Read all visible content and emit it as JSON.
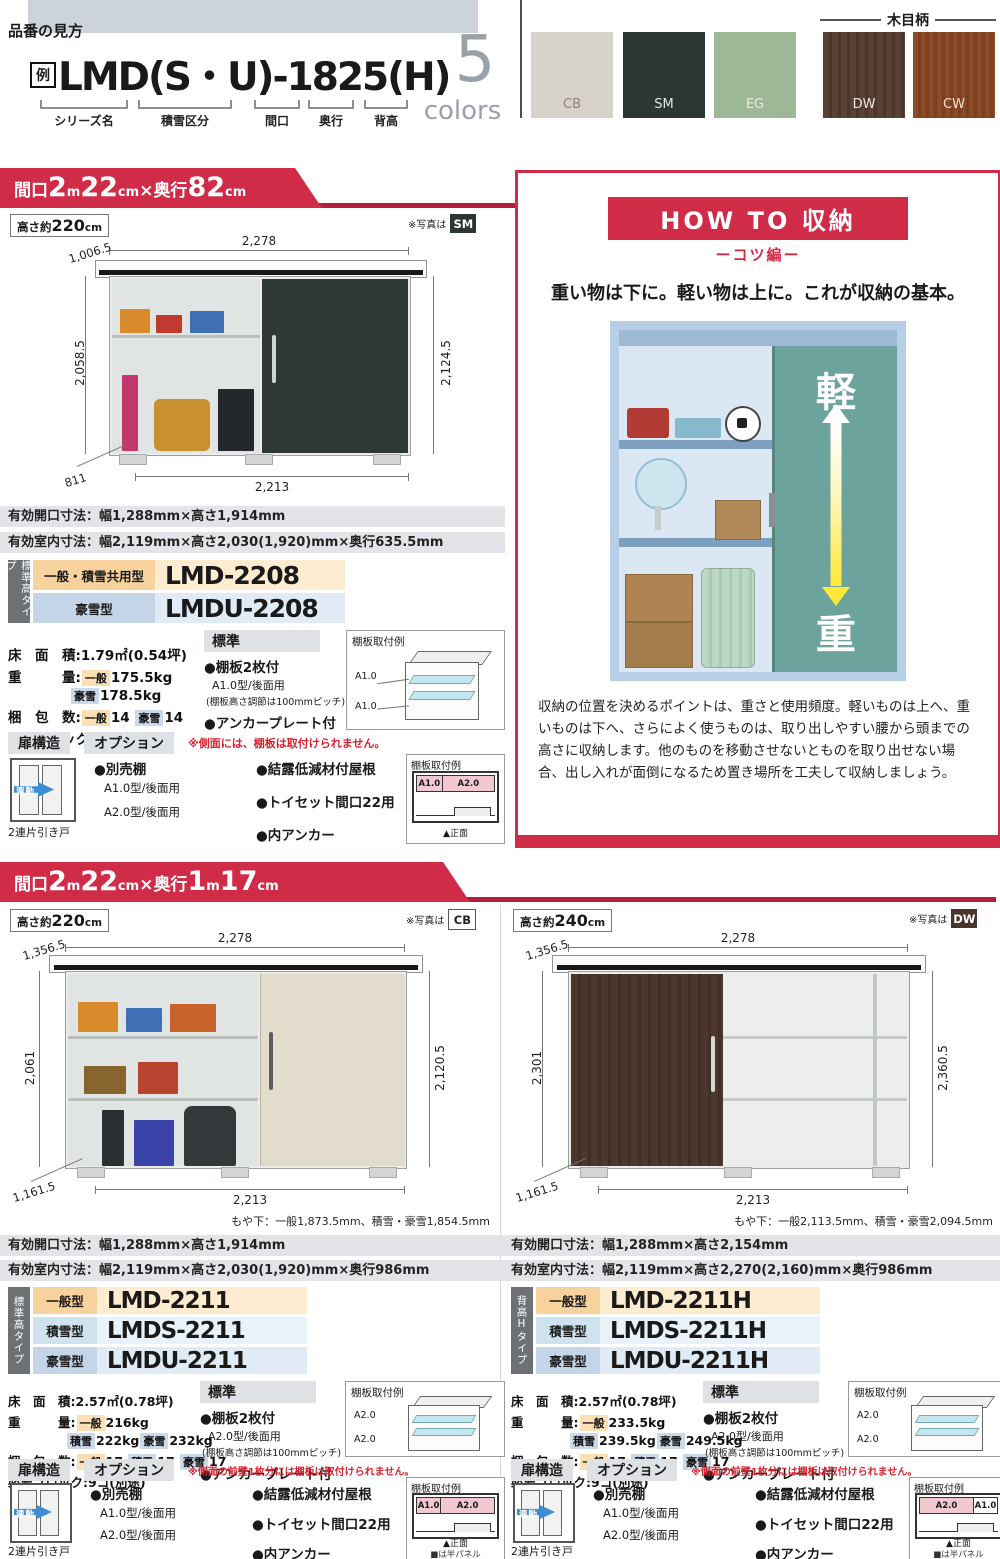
{
  "header": {
    "eyebrow": "品番の見方",
    "example_badge": "例",
    "model_code": "LMD(S・U)-1825(H)",
    "legend": [
      "シリーズ名",
      "積雪区分",
      "間口",
      "奥行",
      "背高"
    ],
    "colors_number": "5",
    "colors_word": "colors",
    "wood_grain_label": "木目柄",
    "swatches": [
      {
        "code": "CB",
        "hex": "#d6d1c9"
      },
      {
        "code": "SM",
        "hex": "#2c3734"
      },
      {
        "code": "EG",
        "hex": "#9eb897"
      },
      {
        "code": "DW",
        "hex": "#5a4136"
      },
      {
        "code": "CW",
        "hex": "#8d4a26"
      }
    ],
    "accent_red": "#d02c47"
  },
  "section1": {
    "ribbon": [
      "間口",
      "2",
      "m",
      "22",
      "cm",
      "×",
      "奥行",
      "82",
      "cm"
    ],
    "height_label": [
      "高さ約",
      "220",
      "cm"
    ],
    "photo_note": "※写真は",
    "photo_chip": "SM",
    "dims": {
      "depth_top": "1,006.5",
      "width_top": "2,278",
      "left": "2,058.5",
      "right": "2,124.5",
      "depth_bottom": "811",
      "width_bottom": "2,213"
    },
    "spec_bars": [
      "有効開口寸法：幅1,288mm×高さ1,914mm",
      "有効室内寸法：幅2,119mm×高さ2,030(1,920)mm×奥行635.5mm"
    ],
    "models": {
      "tab": "標準高タイプ",
      "rows": [
        {
          "type": "一般・積雪共用型",
          "model": "LMD-2208"
        },
        {
          "type": "豪雪型",
          "model": "LMDU-2208"
        }
      ]
    },
    "details": {
      "floor_label": "床　面　積:",
      "floor": "1.79㎡(0.54坪)",
      "weight_label": "重　　　量:",
      "w1_chip": "一般",
      "w1": "175.5kg",
      "w2_chip": "豪雪",
      "w2": "178.5kg",
      "pack_label": "梱　包　数:",
      "p1_chip": "一般",
      "p1": "14",
      "p2_chip": "豪雪",
      "p2": "14",
      "blocks": "必要ブロック:6コ(別途)"
    },
    "standard": {
      "title": "標準",
      "b1": "●棚板2枚付",
      "b1s": "A1.0型/後面用",
      "b1n": "(棚板高さ調節は100mmピッチ)",
      "b2": "●アンカープレート付"
    },
    "shelf_iso": {
      "title": "棚板取付例",
      "l1": "A1.0",
      "l2": "A1.0"
    },
    "dooropt": {
      "door_title": "扉構造",
      "opt_title": "オプション",
      "note": "※側面には、棚板は取付けられません。",
      "door_arrow": "連動",
      "door_caption": "2連片引き戸",
      "o1": "●別売棚",
      "o1a": "A1.0型/後面用",
      "o1b": "A2.0型/後面用",
      "o2": "●結露低減材付屋根",
      "o3": "●トイセット間口22用",
      "o4": "●内アンカー",
      "front": {
        "title": "棚板取付例",
        "c1": "A1.0",
        "c2": "A2.0",
        "caption": "▲正面",
        "caption2": ""
      }
    }
  },
  "howto": {
    "title": "HOW TO 収納",
    "subtitle": "ーコツ編ー",
    "lead": "重い物は下に。軽い物は上に。これが収納の基本。",
    "light_char": "軽",
    "heavy_char": "重",
    "body": "収納の位置を決めるポイントは、重さと使用頻度。軽いものは上へ、重いものは下へ、さらによく使うものは、取り出しやすい腰から頭までの高さに収納します。他のものを移動させないとものを取り出せない場合、出し入れが面倒になるため置き場所を工夫して収納しましょう。"
  },
  "section2": {
    "ribbon": [
      "間口",
      "2",
      "m",
      "22",
      "cm",
      "×",
      "奥行",
      "1",
      "m",
      "17",
      "cm"
    ],
    "columns": [
      {
        "height_label": [
          "高さ約",
          "220",
          "cm"
        ],
        "photo_note": "※写真は",
        "photo_chip": "CB",
        "dims": {
          "depth_top": "1,356.5",
          "width_top": "2,278",
          "left": "2,061",
          "right": "2,120.5",
          "depth_bottom": "1,161.5",
          "width_bottom": "2,213"
        },
        "moya": "もや下：一般1,873.5mm、積雪・豪雪1,854.5mm",
        "spec_bars": [
          "有効開口寸法：幅1,288mm×高さ1,914mm",
          "有効室内寸法：幅2,119mm×高さ2,030(1,920)mm×奥行986mm"
        ],
        "models": {
          "tab": "標準高タイプ",
          "rows": [
            {
              "type": "一般型",
              "model": "LMD-2211"
            },
            {
              "type": "積雪型",
              "model": "LMDS-2211"
            },
            {
              "type": "豪雪型",
              "model": "LMDU-2211"
            }
          ]
        },
        "details": {
          "floor_label": "床　面　積:",
          "floor": "2.57㎡(0.78坪)",
          "weight_label": "重　　　量:",
          "w1_chip": "一般",
          "w1": "216kg",
          "w2_chip": "積雪",
          "w2": "222kg",
          "w3_chip": "豪雪",
          "w3": "232kg",
          "pack_label": "梱　包　数:",
          "p1_chip": "一般",
          "p1": "17",
          "p2_chip": "積雪",
          "p2": "17",
          "p3_chip": "豪雪",
          "p3": "17",
          "blocks": "必要ブロック:9コ(別途)"
        },
        "standard": {
          "title": "標準",
          "b1": "●棚板2枚付",
          "b1s": "A2.0型/後面用",
          "b1n": "(棚板高さ調節は100mmピッチ)",
          "b2": "●アンカープレート付"
        },
        "shelf_iso": {
          "title": "棚板取付例",
          "l1": "A2.0",
          "l2": "A2.0"
        },
        "dooropt": {
          "door_title": "扉構造",
          "opt_title": "オプション",
          "note": "※側面の前壁1枚分には棚板は取付けられません。",
          "door_arrow": "連動",
          "door_caption": "2連片引き戸",
          "o1": "●別売棚",
          "o1a": "A1.0型/後面用",
          "o1b": "A2.0型/後面用",
          "o2": "●結露低減材付屋根",
          "o3": "●トイセット間口22用",
          "o4": "●内アンカー",
          "front": {
            "title": "棚板取付例",
            "c1": "A1.0",
            "c2": "A2.0",
            "caption": "▲正面",
            "caption2": "■は半パネル"
          }
        }
      },
      {
        "height_label": [
          "高さ約",
          "240",
          "cm"
        ],
        "photo_note": "※写真は",
        "photo_chip": "DW",
        "dims": {
          "depth_top": "1,356.5",
          "width_top": "2,278",
          "left": "2,301",
          "right": "2,360.5",
          "depth_bottom": "1,161.5",
          "width_bottom": "2,213"
        },
        "moya": "もや下：一般2,113.5mm、積雪・豪雪2,094.5mm",
        "spec_bars": [
          "有効開口寸法：幅1,288mm×高さ2,154mm",
          "有効室内寸法：幅2,119mm×高さ2,270(2,160)mm×奥行986mm"
        ],
        "models": {
          "tab": "背高Hタイプ",
          "rows": [
            {
              "type": "一般型",
              "model": "LMD-2211H"
            },
            {
              "type": "積雪型",
              "model": "LMDS-2211H"
            },
            {
              "type": "豪雪型",
              "model": "LMDU-2211H"
            }
          ]
        },
        "details": {
          "floor_label": "床　面　積:",
          "floor": "2.57㎡(0.78坪)",
          "weight_label": "重　　　量:",
          "w1_chip": "一般",
          "w1": "233.5kg",
          "w2_chip": "積雪",
          "w2": "239.5kg",
          "w3_chip": "豪雪",
          "w3": "249.5kg",
          "pack_label": "梱　包　数:",
          "p1_chip": "一般",
          "p1": "17",
          "p2_chip": "積雪",
          "p2": "17",
          "p3_chip": "豪雪",
          "p3": "17",
          "blocks": "必要ブロック:9コ(別途)"
        },
        "standard": {
          "title": "標準",
          "b1": "●棚板2枚付",
          "b1s": "A2.0型/後面用",
          "b1n": "(棚板高さ調節は100mmピッチ)",
          "b2": "●アンカープレート付"
        },
        "shelf_iso": {
          "title": "棚板取付例",
          "l1": "A2.0",
          "l2": "A2.0"
        },
        "dooropt": {
          "door_title": "扉構造",
          "opt_title": "オプション",
          "note": "※側面の前壁1枚分には棚板は取付けられません。",
          "door_arrow": "連動",
          "door_caption": "2連片引き戸",
          "o1": "●別売棚",
          "o1a": "A1.0型/後面用",
          "o1b": "A2.0型/後面用",
          "o2": "●結露低減材付屋根",
          "o3": "●トイセット間口22用",
          "o4": "●内アンカー",
          "front": {
            "title": "棚板取付例",
            "c1": "A2.0",
            "c2": "A1.0",
            "caption": "▲正面",
            "caption2": "■は半パネル"
          }
        }
      }
    ]
  }
}
